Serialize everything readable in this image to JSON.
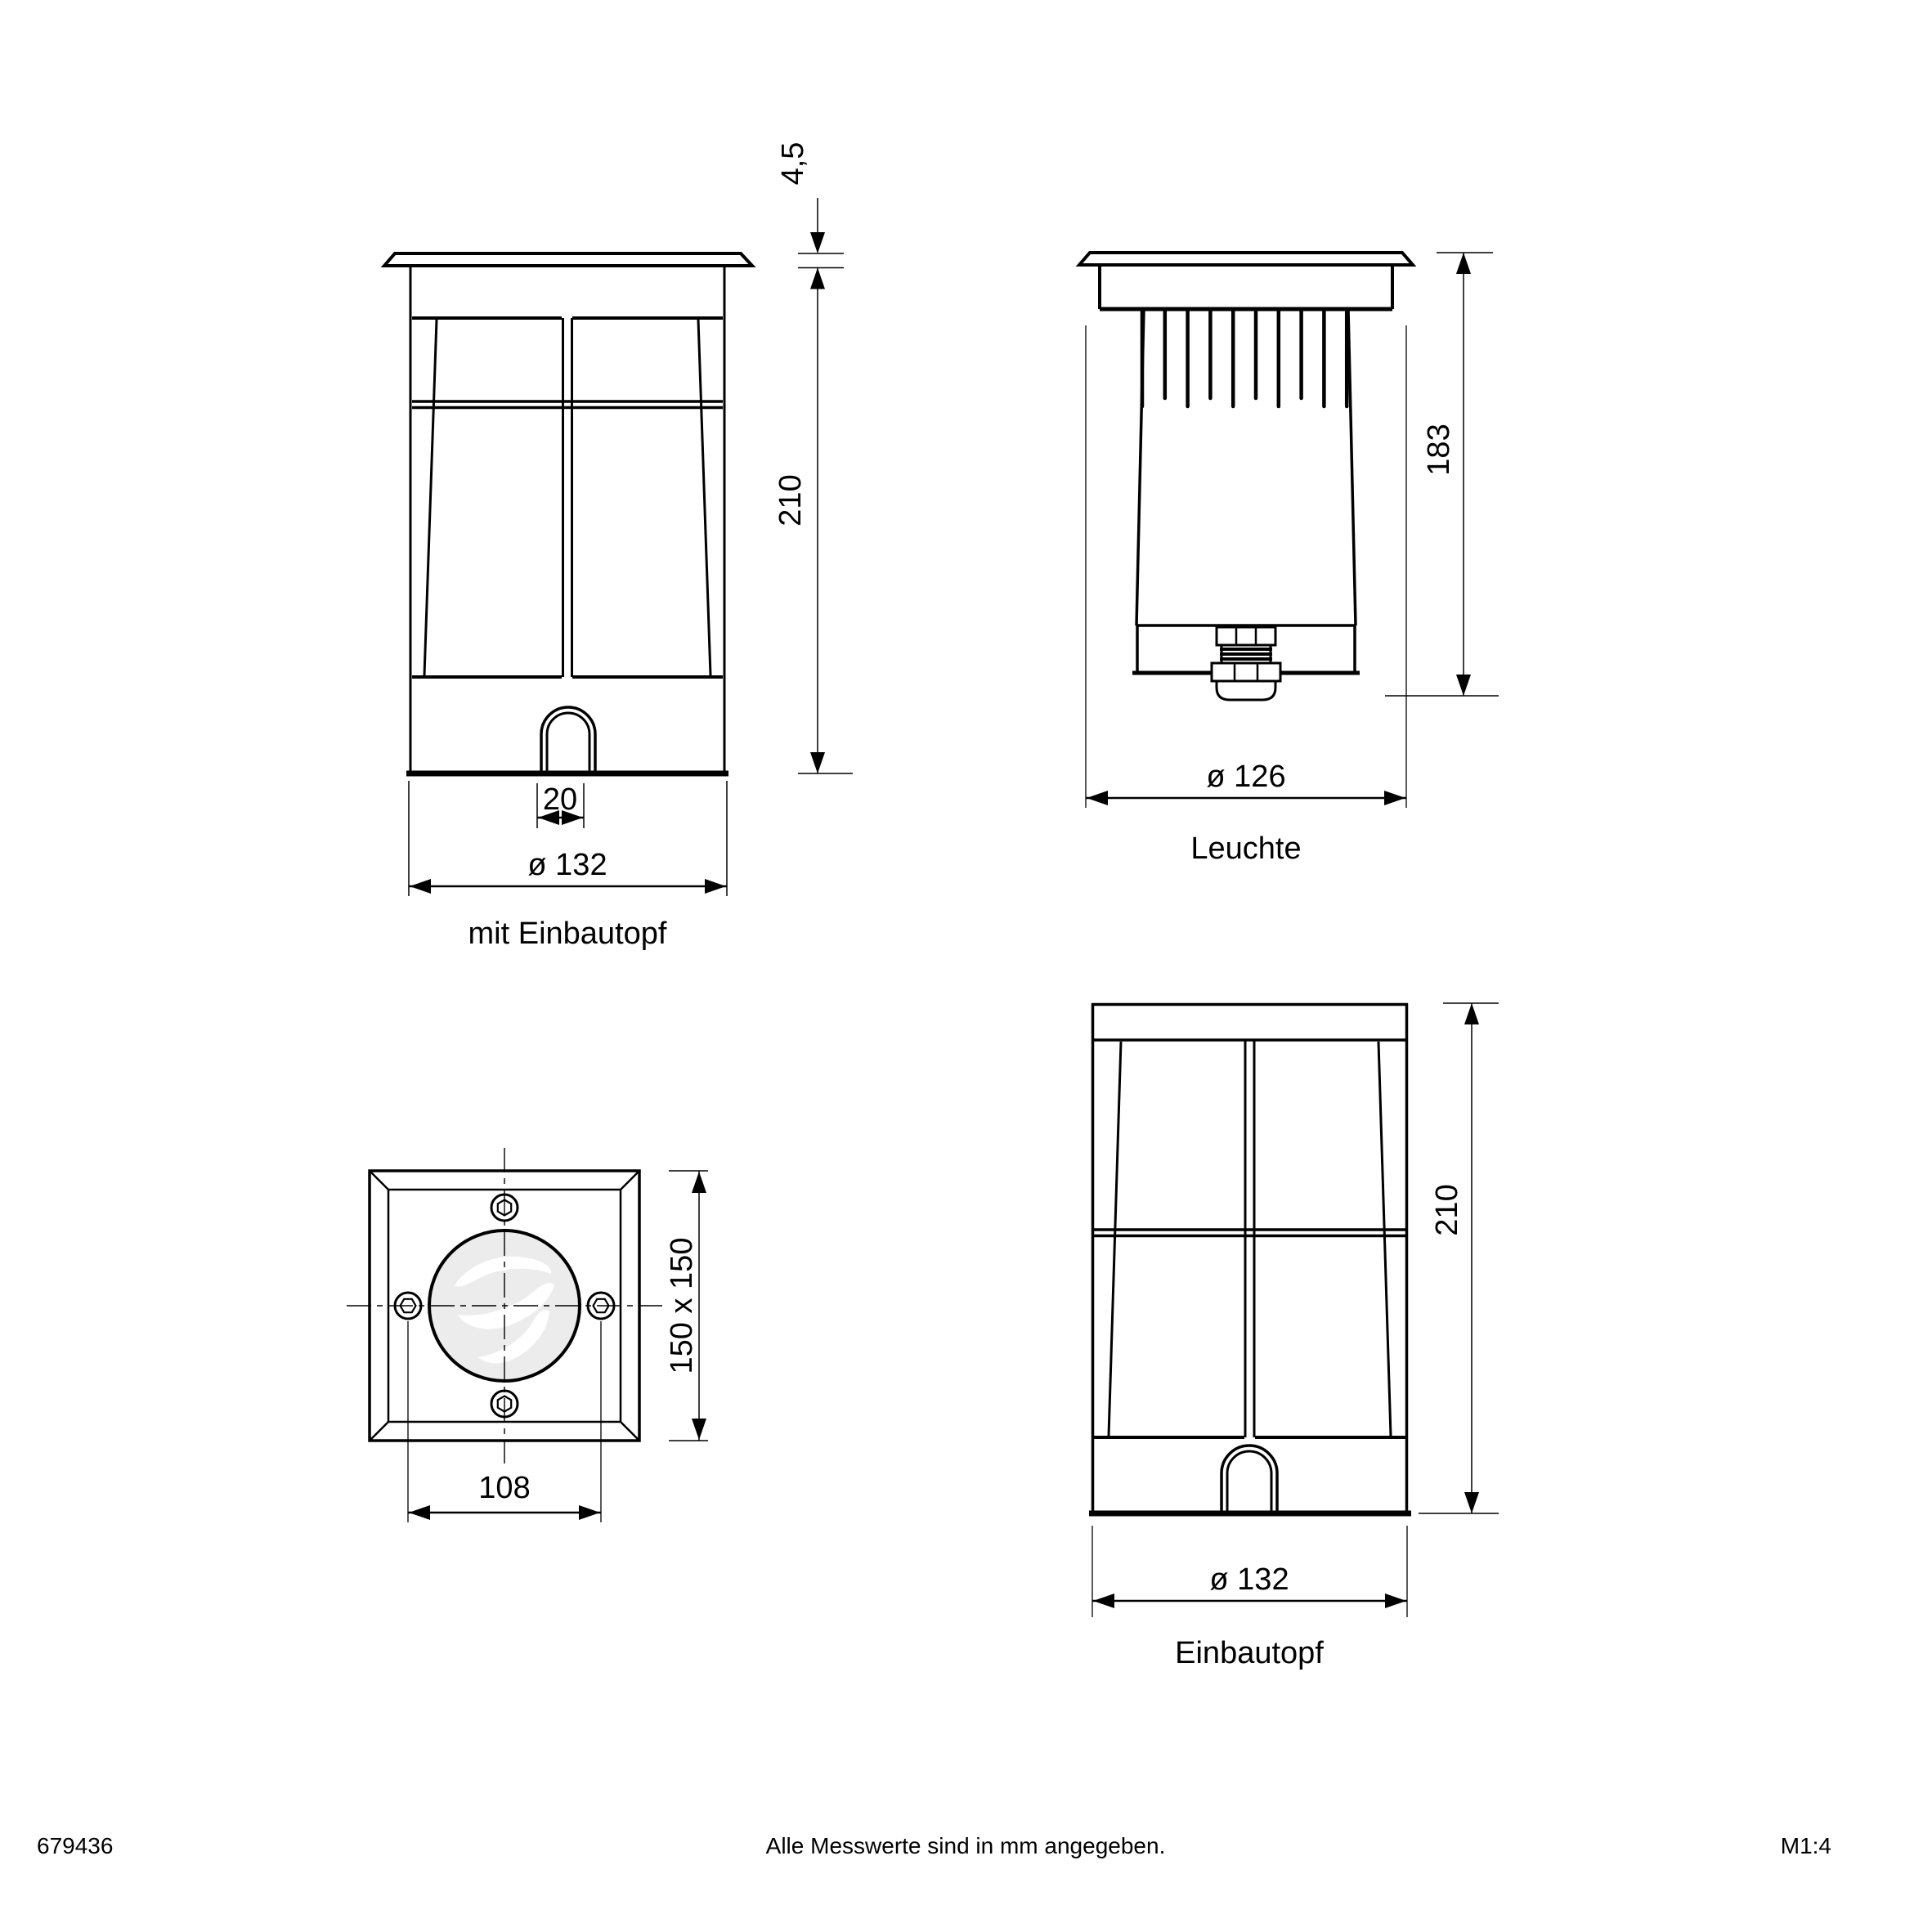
{
  "document": {
    "background": "#ffffff",
    "line_color": "#000000",
    "glass_fill": "#ececec"
  },
  "views": {
    "front_with_pot": {
      "label": "mit Einbautopf",
      "dim_flange_height": "4,5",
      "dim_height": "210",
      "dim_slot_width": "20",
      "dim_diameter": "ø 132"
    },
    "luminaire": {
      "label": "Leuchte",
      "dim_height": "183",
      "dim_diameter": "ø 126"
    },
    "top_view": {
      "dim_plate": "150 x 150",
      "dim_screw_spacing": "108"
    },
    "pot_only": {
      "label": "Einbautopf",
      "dim_height": "210",
      "dim_diameter": "ø 132"
    }
  },
  "footer": {
    "article_number": "679436",
    "note": "Alle Messwerte sind in mm angegeben.",
    "scale": "M1:4"
  }
}
